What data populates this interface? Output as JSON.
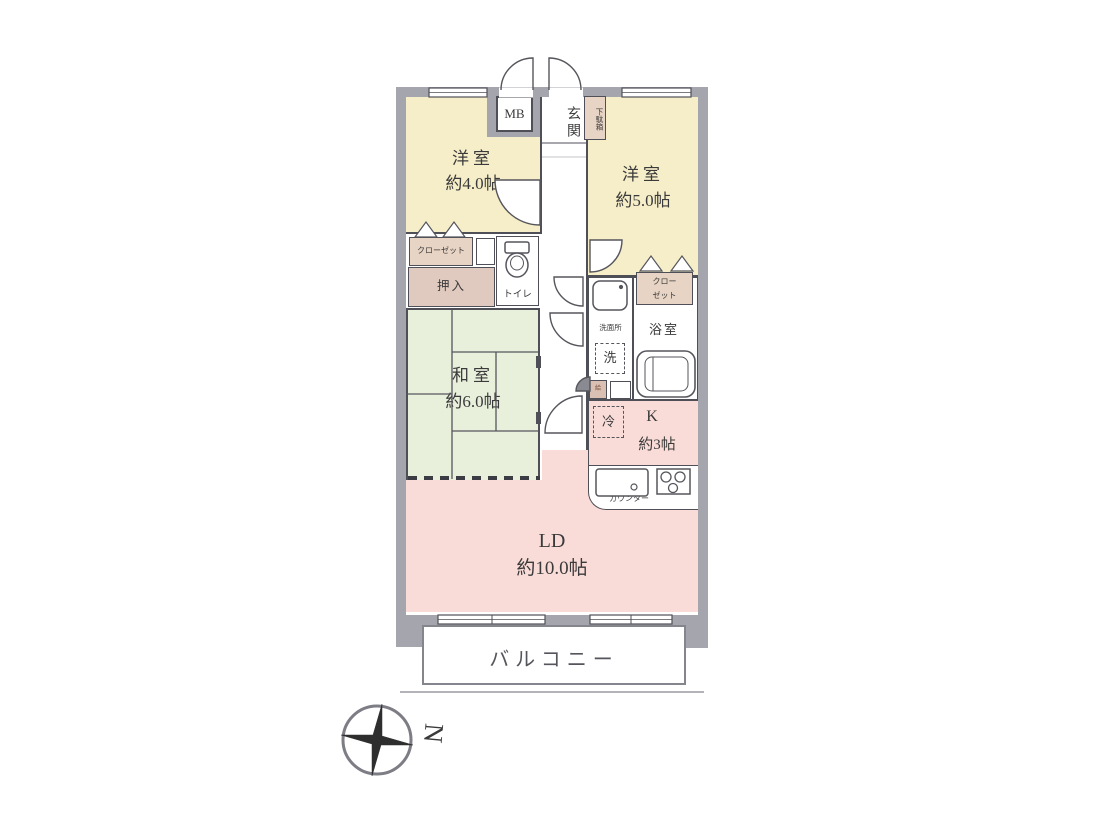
{
  "colors": {
    "wall": "#a5a5ad",
    "western_room_fill": "#f6edc9",
    "japanese_room_fill": "#e8f0dc",
    "living_kitchen_fill": "#f9dcd8",
    "closet_fill": "#e8d4c4",
    "oshiire_fill": "#e0c9be",
    "outline": "#4f4f57"
  },
  "rooms": {
    "western1": {
      "name": "洋室",
      "size": "約4.0帖"
    },
    "western2": {
      "name": "洋室",
      "size": "約5.0帖"
    },
    "japanese": {
      "name": "和室",
      "size": "約6.0帖"
    },
    "living_dining": {
      "name": "LD",
      "size": "約10.0帖"
    },
    "kitchen": {
      "name": "K",
      "size": "約3帖"
    }
  },
  "labels": {
    "balcony": "バルコニー",
    "entrance": "玄関",
    "meter_box": "MB",
    "shoe_box": "下駄箱",
    "closet_left": "クローゼット",
    "closet_right_line1": "クロー",
    "closet_right_line2": "ゼット",
    "oshiire": "押入",
    "toilet": "トイレ",
    "washroom": "洗面所",
    "washer": "洗",
    "bathroom": "浴室",
    "refrigerator": "冷",
    "counter": "カウンター",
    "water_heater": "給",
    "compass_north": "N"
  }
}
